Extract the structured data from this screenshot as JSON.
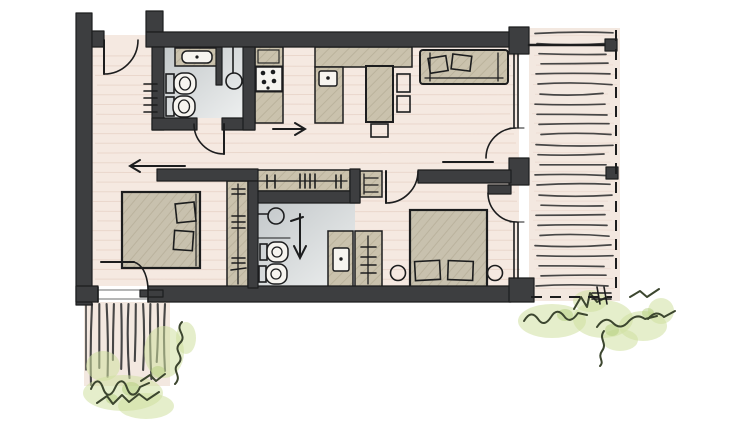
{
  "colors": {
    "ink": "#1c1d1e",
    "wall": "#3d3e40",
    "floor_wood": "#f5e9e1",
    "plank_line": "#e0c9bc",
    "furniture_tan": "#cac2ad",
    "furniture_hatch": "#a89f86",
    "bed_fill": "#c8c1ae",
    "bath_floor_dark": "#c3c8ca",
    "bath_floor_light": "#edefef",
    "fixture_white": "#f6f4ef",
    "terrace_floor": "#f3e8e0",
    "deck_stroke": "#2e2f30",
    "plant_green": "#cfe0a1",
    "plant_green_dark": "#b4cd7d",
    "plant_ink": "#3c462f"
  },
  "scene": {
    "type": "hand-drawn-apartment-floor-plan",
    "rooms": [
      {
        "name": "entry-hall",
        "fixtures": [
          "entry-door",
          "radiator"
        ]
      },
      {
        "name": "bathroom-top",
        "fixtures": [
          "washbasin",
          "shower",
          "toilet",
          "bidet",
          "door"
        ]
      },
      {
        "name": "kitchen-dining",
        "fixtures": [
          "cooktop",
          "counter",
          "kitchen-sink",
          "dining-table",
          "chair",
          "chair",
          "chair"
        ]
      },
      {
        "name": "living-area",
        "fixtures": [
          "sofa",
          "terrace-door"
        ]
      },
      {
        "name": "hall-closet",
        "fixtures": [
          "hanging-rail",
          "shelf-cabinet"
        ]
      },
      {
        "name": "bedroom-left",
        "fixtures": [
          "double-bed",
          "wardrobe",
          "terrace-door"
        ]
      },
      {
        "name": "bathroom-bottom",
        "fixtures": [
          "shower",
          "toilet",
          "bidet",
          "vanity-basin"
        ]
      },
      {
        "name": "bedroom-right",
        "fixtures": [
          "double-bed",
          "side-table",
          "side-table",
          "wardrobe",
          "room-door",
          "terrace-door"
        ]
      },
      {
        "name": "terrace-right",
        "features": [
          "deck-boards",
          "railing",
          "railing-posts",
          "dashed-boundary"
        ]
      },
      {
        "name": "terrace-bottom-left",
        "features": [
          "deck-boards",
          "shrubs"
        ]
      }
    ],
    "counts": {
      "door_swings": 6,
      "beds": 2,
      "toilets": 4,
      "showers": 2,
      "direction_arrows": 3,
      "railing_posts": 2,
      "plant_clusters": 2,
      "dining_chairs": 3,
      "side_tables": 2
    }
  },
  "decor": {
    "floor_planks": {
      "orient": "h",
      "count": 24,
      "y0": 56,
      "dy": 9.7,
      "x1": 94,
      "x2": 517,
      "wave": 0.5
    },
    "terrace_planks": {
      "orient": "h",
      "count": 27,
      "y0": 36,
      "dy": 9.7,
      "x1": 533,
      "x2": 615,
      "wave": 0.4
    },
    "deck_right": {
      "orient": "h",
      "count": 26,
      "y0": 33.5,
      "dy": 10.1,
      "x1": 538,
      "x2": 610,
      "wave": 1.2
    },
    "deck_bottom": {
      "orient": "v",
      "count": 11,
      "x0": 92,
      "dx": 7.3,
      "y1": 304,
      "y2": 385,
      "vary": 26
    }
  }
}
